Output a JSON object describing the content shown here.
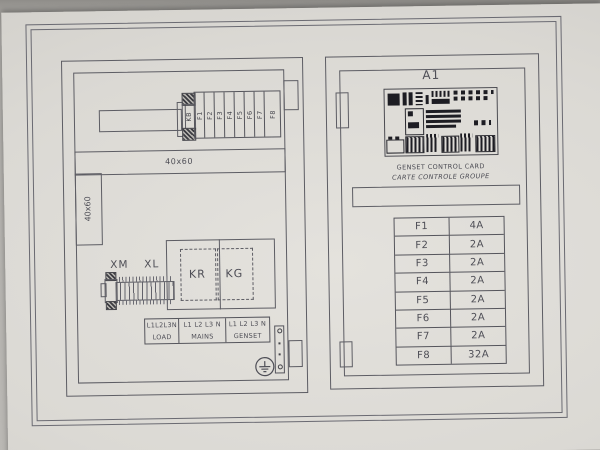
{
  "left_panel": {
    "breaker_block": {
      "cells": [
        "KB",
        "F1",
        "F2",
        "F3",
        "F4",
        "F5",
        "F6",
        "F7",
        "F8"
      ]
    },
    "duct_top_label": "40x60",
    "duct_side_label": "40x60",
    "terminal_group_left": "XM",
    "terminal_group_right": "XL",
    "contactor_left": "KR",
    "contactor_right": "KG",
    "connection_table": {
      "columns": [
        {
          "phases": "L1L2L3N",
          "name": "LOAD"
        },
        {
          "phases": "L1 L2 L3 N",
          "name": "MAINS"
        },
        {
          "phases": "L1 L2 L3 N",
          "name": "GENSET"
        }
      ]
    }
  },
  "right_panel": {
    "device_tag": "A1",
    "card_title_en": "GENSET CONTROL CARD",
    "card_title_fr": "CARTE CONTROLE GROUPE",
    "fuse_table": {
      "rows": [
        {
          "fuse": "F1",
          "rating": "4A"
        },
        {
          "fuse": "F2",
          "rating": "2A"
        },
        {
          "fuse": "F3",
          "rating": "2A"
        },
        {
          "fuse": "F4",
          "rating": "2A"
        },
        {
          "fuse": "F5",
          "rating": "2A"
        },
        {
          "fuse": "F6",
          "rating": "2A"
        },
        {
          "fuse": "F7",
          "rating": "2A"
        },
        {
          "fuse": "F8",
          "rating": "32A"
        }
      ]
    }
  }
}
